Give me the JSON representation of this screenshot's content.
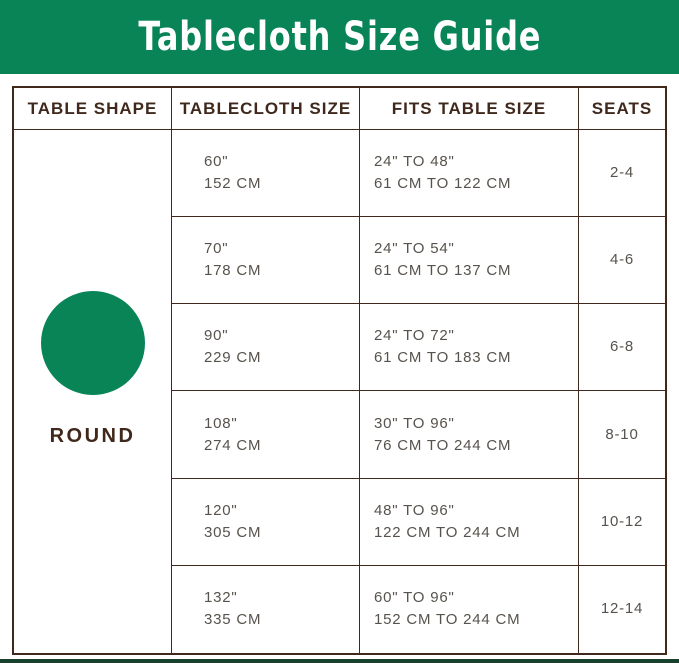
{
  "colors": {
    "green": "#088457",
    "border": "#40291c",
    "text": "#57524c",
    "darkgreen": "#17412d"
  },
  "chart_data": {
    "type": "table",
    "title": "Tablecloth Size Guide",
    "columns": [
      "TABLE SHAPE",
      "TABLECLOTH SIZE",
      "FITS TABLE SIZE",
      "SEATS"
    ],
    "shape_label": "ROUND",
    "shape_icon": "round-circle",
    "rows": [
      {
        "tablecloth_in": "60\"",
        "tablecloth_cm": "152 CM",
        "fits_in": "24\" TO 48\"",
        "fits_cm": "61 CM TO 122 CM",
        "seats": "2-4"
      },
      {
        "tablecloth_in": "70\"",
        "tablecloth_cm": "178 CM",
        "fits_in": "24\" TO 54\"",
        "fits_cm": "61 CM TO 137 CM",
        "seats": "4-6"
      },
      {
        "tablecloth_in": "90\"",
        "tablecloth_cm": "229 CM",
        "fits_in": "24\" TO 72\"",
        "fits_cm": "61 CM TO 183 CM",
        "seats": "6-8"
      },
      {
        "tablecloth_in": "108\"",
        "tablecloth_cm": "274 CM",
        "fits_in": "30\" TO 96\"",
        "fits_cm": "76 CM TO 244 CM",
        "seats": "8-10"
      },
      {
        "tablecloth_in": "120\"",
        "tablecloth_cm": "305 CM",
        "fits_in": "48\" TO 96\"",
        "fits_cm": "122 CM TO 244 CM",
        "seats": "10-12"
      },
      {
        "tablecloth_in": "132\"",
        "tablecloth_cm": "335 CM",
        "fits_in": "60\" TO 96\"",
        "fits_cm": "152 CM TO 244 CM",
        "seats": "12-14"
      }
    ]
  }
}
